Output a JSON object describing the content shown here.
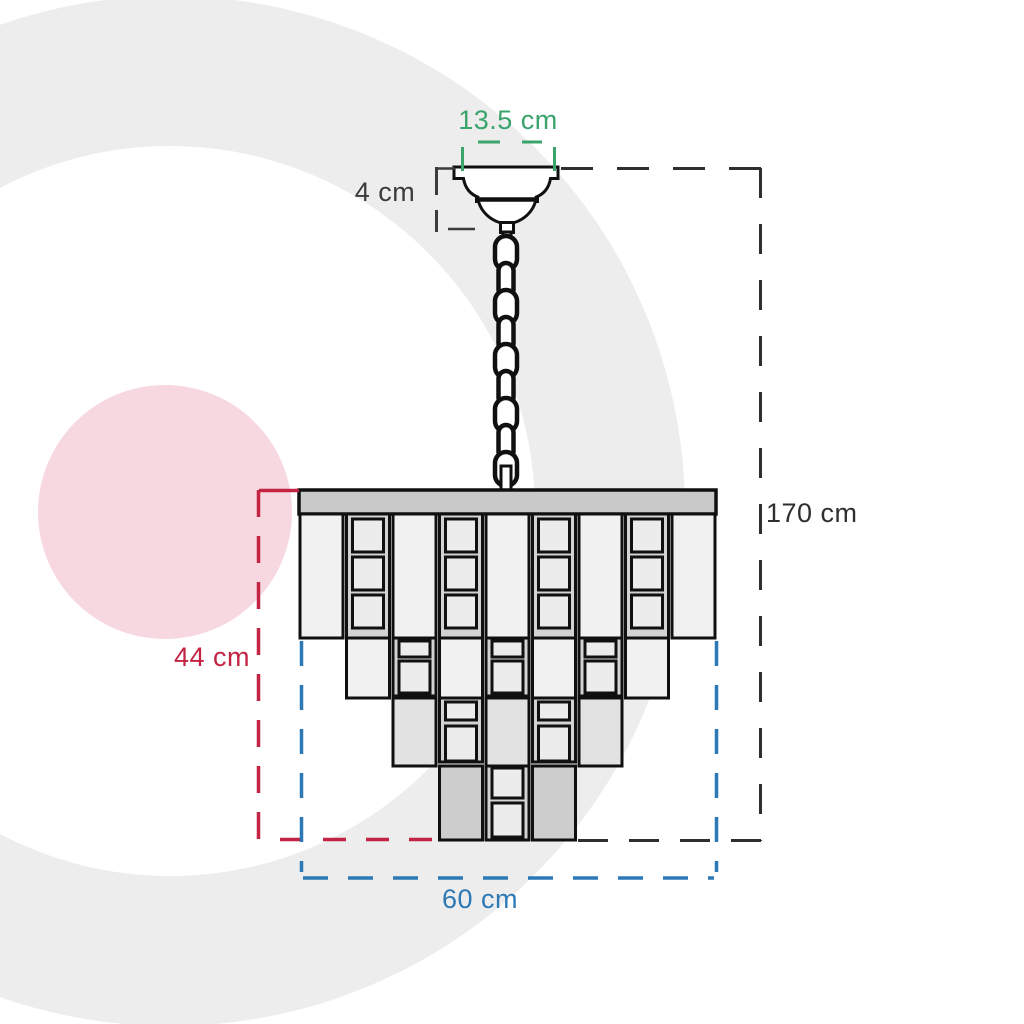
{
  "dimensions": {
    "canopy_width": {
      "label": "13.5 cm",
      "color": "#3aa46c"
    },
    "canopy_height": {
      "label": "4 cm",
      "color": "#3b3b3b"
    },
    "total_height": {
      "label": "170 cm",
      "color": "#2f2f2f"
    },
    "body_height": {
      "label": "44 cm",
      "color": "#c32443"
    },
    "body_width": {
      "label": "60 cm",
      "color": "#2d79b5"
    }
  },
  "watermark": {
    "ring_color": "#ededed",
    "circle_color": "#f8d8e0"
  },
  "figure": {
    "outline_color": "#101010",
    "plate": {
      "x": 299,
      "y": 490,
      "w": 417,
      "h": 24,
      "fill": "#c9c9c9"
    },
    "grid": {
      "x0": 300,
      "pitch": 46.5,
      "col_w": 43
    },
    "colors": {
      "p": "#f1f1f1",
      "g": "#e2e2e2",
      "d": "#cdcdcd",
      "crystal_bg": "#d3d3d3",
      "crystal_face": "#ececec"
    },
    "tiers": [
      {
        "y": 514,
        "h": 124,
        "start_col": 0,
        "crystal_h": 126,
        "pattern": [
          "p",
          "c",
          "p",
          "c",
          "p",
          "c",
          "p",
          "c",
          "p"
        ],
        "crystals": [
          [
            5,
            33
          ],
          [
            43,
            33
          ],
          [
            81,
            33
          ]
        ]
      },
      {
        "y": 638,
        "h": 60,
        "start_col": 1,
        "crystal_h": 58,
        "pattern": [
          "p",
          "c",
          "p",
          "c",
          "p",
          "c",
          "p"
        ],
        "crystals": [
          [
            3,
            16
          ],
          [
            23,
            32
          ]
        ]
      },
      {
        "y": 698,
        "h": 68,
        "start_col": 2,
        "crystal_h": 64,
        "pattern": [
          "g",
          "c",
          "g",
          "c",
          "g"
        ],
        "crystals": [
          [
            4,
            18
          ],
          [
            28,
            35
          ]
        ]
      },
      {
        "y": 766,
        "h": 74,
        "start_col": 3,
        "crystal_h": 74,
        "pattern": [
          "d",
          "c",
          "d"
        ],
        "crystals": [
          [
            2,
            30
          ],
          [
            37,
            34
          ]
        ]
      }
    ],
    "chain": {
      "cx": 506,
      "y0": 236,
      "spacing": 27,
      "links": 9,
      "w_major": 22,
      "w_minor": 15,
      "h": 34
    }
  }
}
